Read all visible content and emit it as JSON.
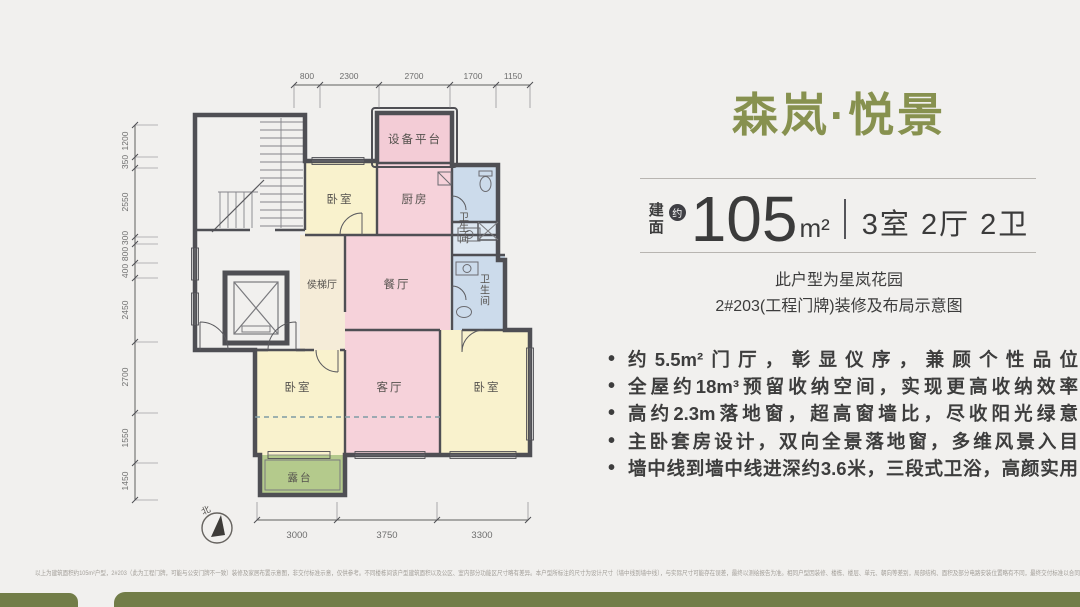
{
  "panel": {
    "title": "森岚·悦景",
    "area": {
      "label": "建面",
      "approx": "约",
      "value": "105",
      "unit": "m²",
      "layout": "3室 2厅 2卫"
    },
    "subtitle_line1": "此户型为星岚花园",
    "subtitle_line2": "2#203(工程门牌)装修及布局示意图",
    "bullet_marker": "•",
    "bullets": [
      "约5.5m²门厅，彰显仪序，兼顾个性品位",
      "全屋约18m³预留收纳空间，实现更高收纳效率",
      "高约2.3m落地窗，超高窗墙比，尽收阳光绿意",
      "主卧套房设计，双向全景落地窗，多维风景入目",
      "墙中线到墙中线进深约3.6米，三段式卫浴，高颜实用"
    ]
  },
  "floorplan": {
    "north": "北",
    "rooms": {
      "equipment_platform": "设备平台",
      "bedroom_top": "卧室",
      "kitchen": "厨房",
      "bath_top": "卫生间",
      "elevator_hall": "侯梯厅",
      "dining": "餐厅",
      "bath_bottom": "卫生间",
      "bedroom_left": "卧室",
      "living": "客厅",
      "bedroom_right": "卧室",
      "terrace": "露台"
    },
    "dims": {
      "top": [
        "800",
        "2300",
        "2700",
        "1700",
        "1150"
      ],
      "left": [
        "1200",
        "350",
        "2550",
        "300",
        "800",
        "400",
        "2450",
        "2700",
        "1550",
        "1450"
      ],
      "bottom": [
        "3000",
        "3750",
        "3300"
      ]
    }
  },
  "disclaimer": "以上为建筑面积约105m²户型，2#203（此为工程门牌，可能与公安门牌不一致）装修及家居布置示意图，非交付标准示意，仅供参考。不同楼栋间该户型建筑面积以及公区、室内部分功能区尺寸略有差异。本户型所标注的尺寸为设计尺寸（墙中线到墙中线），与实际尺寸可能存在误差，最终以测绘报告为准。相同户型因装修、楼栋、楼层、单元、朝向等差别，局部结构、面积及部分电路安装位置略有不同，最终交付标准以合同约定为准。",
  "colors": {
    "accent_green": "#87914f",
    "footer_bar": "#727d48",
    "wall": "#4f4f54",
    "room_pink": "#f6d2da",
    "room_yellow": "#f9f2cd",
    "room_blue": "#ccdbeb",
    "room_green": "#b4ca8c",
    "room_beige": "#f5ecd8"
  }
}
